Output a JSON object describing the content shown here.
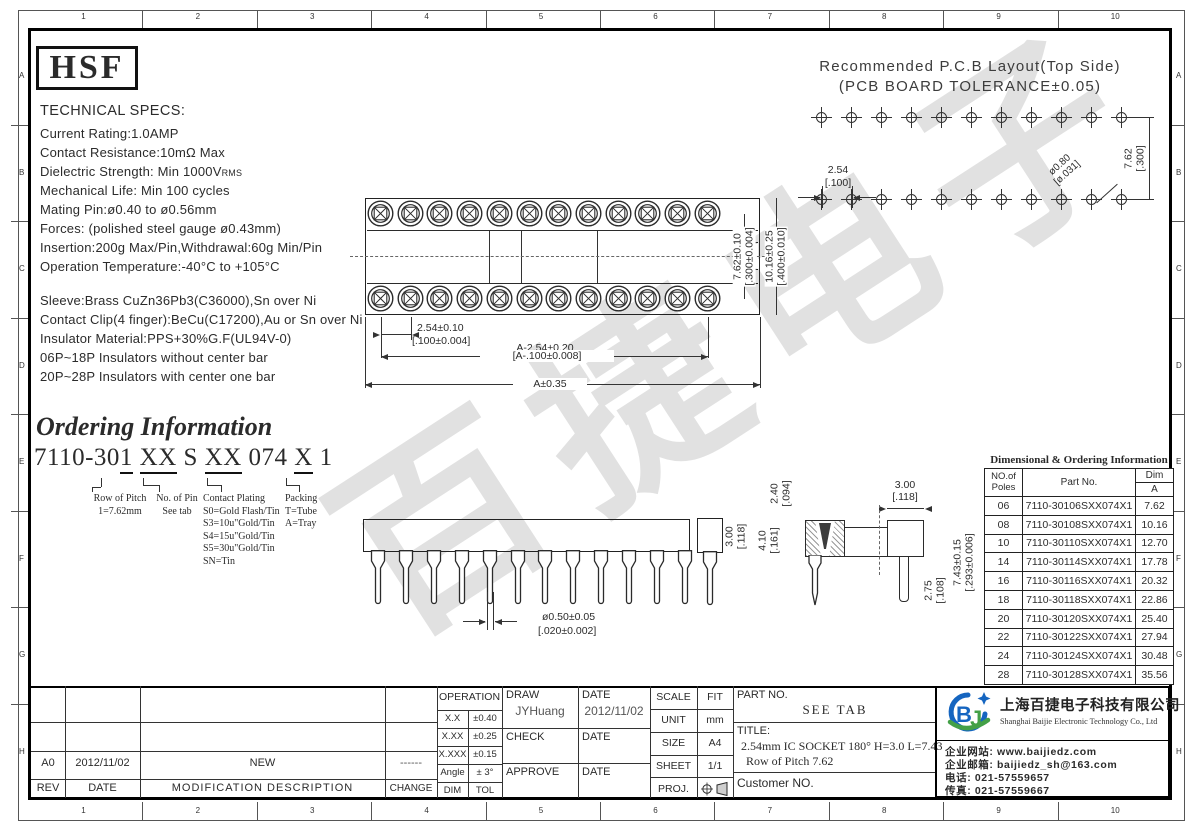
{
  "frame": {
    "numbers": [
      "1",
      "2",
      "3",
      "4",
      "5",
      "6",
      "7",
      "8",
      "9",
      "10"
    ],
    "letters": [
      "A",
      "B",
      "C",
      "D",
      "E",
      "F",
      "G",
      "H"
    ]
  },
  "logo": {
    "text": "HSF"
  },
  "tech_specs": {
    "title": "TECHNICAL SPECS:",
    "lines": [
      "Current Rating:1.0AMP",
      "Contact Resistance:10mΩ Max",
      "Dielectric Strength: Min 1000V",
      "Mechanical Life: Min 100 cycles",
      "Mating Pin:ø0.40 to ø0.56mm",
      "Forces: (polished steel gauge ø0.43mm)",
      "Insertion:200g Max/Pin,Withdrawal:60g Min/Pin",
      "Operation Temperature:-40°C to +105°C"
    ],
    "rms": "RMS"
  },
  "material_specs": {
    "lines": [
      "Sleeve:Brass CuZn36Pb3(C36000),Sn over Ni",
      "Contact Clip(4 finger):BeCu(C17200),Au or Sn over Ni",
      "Insulator Material:PPS+30%G.F(UL94V-0)",
      "06P~18P Insulators without center bar",
      "20P~28P Insulators with center one bar"
    ]
  },
  "pcb_layout": {
    "title_line1": "Recommended P.C.B Layout(Top Side)",
    "title_line2": "(PCB BOARD TOLERANCE±0.05)",
    "holes_per_row": 11,
    "dims": {
      "pitch": "2.54",
      "pitch_in": "[.100]",
      "row": "7.62",
      "row_in": "[.300]",
      "hole": "ø0.80",
      "hole_in": "[ø.031]"
    }
  },
  "top_view": {
    "holes_per_row": 12,
    "dims": {
      "row": "7.62±0.10",
      "row_in": "[.300±0.004]",
      "height": "10.16±0.25",
      "height_in": "[.400±0.010]",
      "pitch": "2.54±0.10",
      "pitch_in": "[.100±0.004]",
      "span": "A-2.54±0.20",
      "span_in": "[A-.100±0.008]",
      "overall": "A±0.35"
    }
  },
  "ordering": {
    "title": "Ordering Information",
    "part_segments": [
      "7110-30",
      "1",
      " ",
      "XX",
      " S ",
      "XX",
      " 074 ",
      "X",
      " 1"
    ],
    "groups": [
      {
        "title": "Row of Pitch",
        "items": [
          "1=7.62mm"
        ]
      },
      {
        "title": "No. of Pin",
        "items": [
          "See tab"
        ]
      },
      {
        "title": "Contact Plating",
        "items": [
          "S0=Gold Flash/Tin",
          "S3=10u\"Gold/Tin",
          "S4=15u\"Gold/Tin",
          "S5=30u\"Gold/Tin",
          "SN=Tin"
        ]
      },
      {
        "title": "Packing",
        "items": [
          "T=Tube",
          "A=Tray"
        ]
      }
    ]
  },
  "side_view": {
    "pin_count": 12,
    "dims": {
      "height": "3.00",
      "height_in": "[.118]",
      "pin_dia": "ø0.50±0.05",
      "pin_dia_in": "[.020±0.002]"
    }
  },
  "section_view": {
    "dims": {
      "width": "3.00",
      "width_in": "[.118]",
      "entry": "2.40",
      "entry_in": "[.094]",
      "depth": "4.10",
      "depth_in": "[.161]",
      "overall": "7.43±0.15",
      "overall_in": "[.293±0.006]",
      "tail": "2.75",
      "tail_in": "[.108]"
    }
  },
  "dim_table": {
    "title": "Dimensional & Ordering Information",
    "headers": {
      "poles1": "NO.of",
      "poles2": "Poles",
      "part": "Part No.",
      "dim": "Dim",
      "a": "A"
    },
    "rows": [
      [
        "06",
        "7110-30106SXX074X1",
        "7.62"
      ],
      [
        "08",
        "7110-30108SXX074X1",
        "10.16"
      ],
      [
        "10",
        "7110-30110SXX074X1",
        "12.70"
      ],
      [
        "14",
        "7110-30114SXX074X1",
        "17.78"
      ],
      [
        "16",
        "7110-30116SXX074X1",
        "20.32"
      ],
      [
        "18",
        "7110-30118SXX074X1",
        "22.86"
      ],
      [
        "20",
        "7110-30120SXX074X1",
        "25.40"
      ],
      [
        "22",
        "7110-30122SXX074X1",
        "27.94"
      ],
      [
        "24",
        "7110-30124SXX074X1",
        "30.48"
      ],
      [
        "28",
        "7110-30128SXX074X1",
        "35.56"
      ]
    ]
  },
  "title_block": {
    "rev": {
      "rev": "A0",
      "date": "2012/11/02",
      "desc": "NEW",
      "change": "------",
      "h_rev": "REV",
      "h_date": "DATE",
      "h_desc": "MODIFICATION DESCRIPTION",
      "h_change": "CHANGE"
    },
    "tol": {
      "header": "OPERATION",
      "r1l": "X.X",
      "r1v": "±0.40",
      "r2l": "X.XX",
      "r2v": "±0.25",
      "r3l": "X.XXX",
      "r3v": "±0.15",
      "r4l": "Angle",
      "r4v": "± 3°",
      "r5l": "DIM",
      "r5v": "TOL"
    },
    "sign": {
      "draw": "DRAW",
      "draw_name": "JYHuang",
      "date": "DATE",
      "draw_date": "2012/11/02",
      "check": "CHECK",
      "approve": "APPROVE"
    },
    "info": {
      "scale": "SCALE",
      "scale_v": "FIT",
      "unit": "UNIT",
      "unit_v": "mm",
      "size": "SIZE",
      "size_v": "A4",
      "sheet": "SHEET",
      "sheet_v": "1/1",
      "proj": "PROJ."
    },
    "part": {
      "label": "PART NO.",
      "value": "SEE TAB",
      "title_label": "TITLE:",
      "title1": "2.54mm IC SOCKET 180° H=3.0 L=7.43",
      "title2": "Row of Pitch 7.62",
      "customer": "Customer NO."
    }
  },
  "company": {
    "name_cn": "上海百捷电子科技有限公司",
    "name_en": "Shanghai Baijie Electronic Technology Co., Ltd",
    "website": "企业网站: www.baijiedz.com",
    "email": "企业邮箱: baijiedz_sh@163.com",
    "tel": "电话: 021-57559657",
    "fax": "传真: 021-57559667"
  },
  "watermark": "百捷电子",
  "colors": {
    "line": "#2b2b2b",
    "logo_blue": "#1565c0",
    "logo_green": "#43a047",
    "watermark": "#dcdcdc"
  }
}
